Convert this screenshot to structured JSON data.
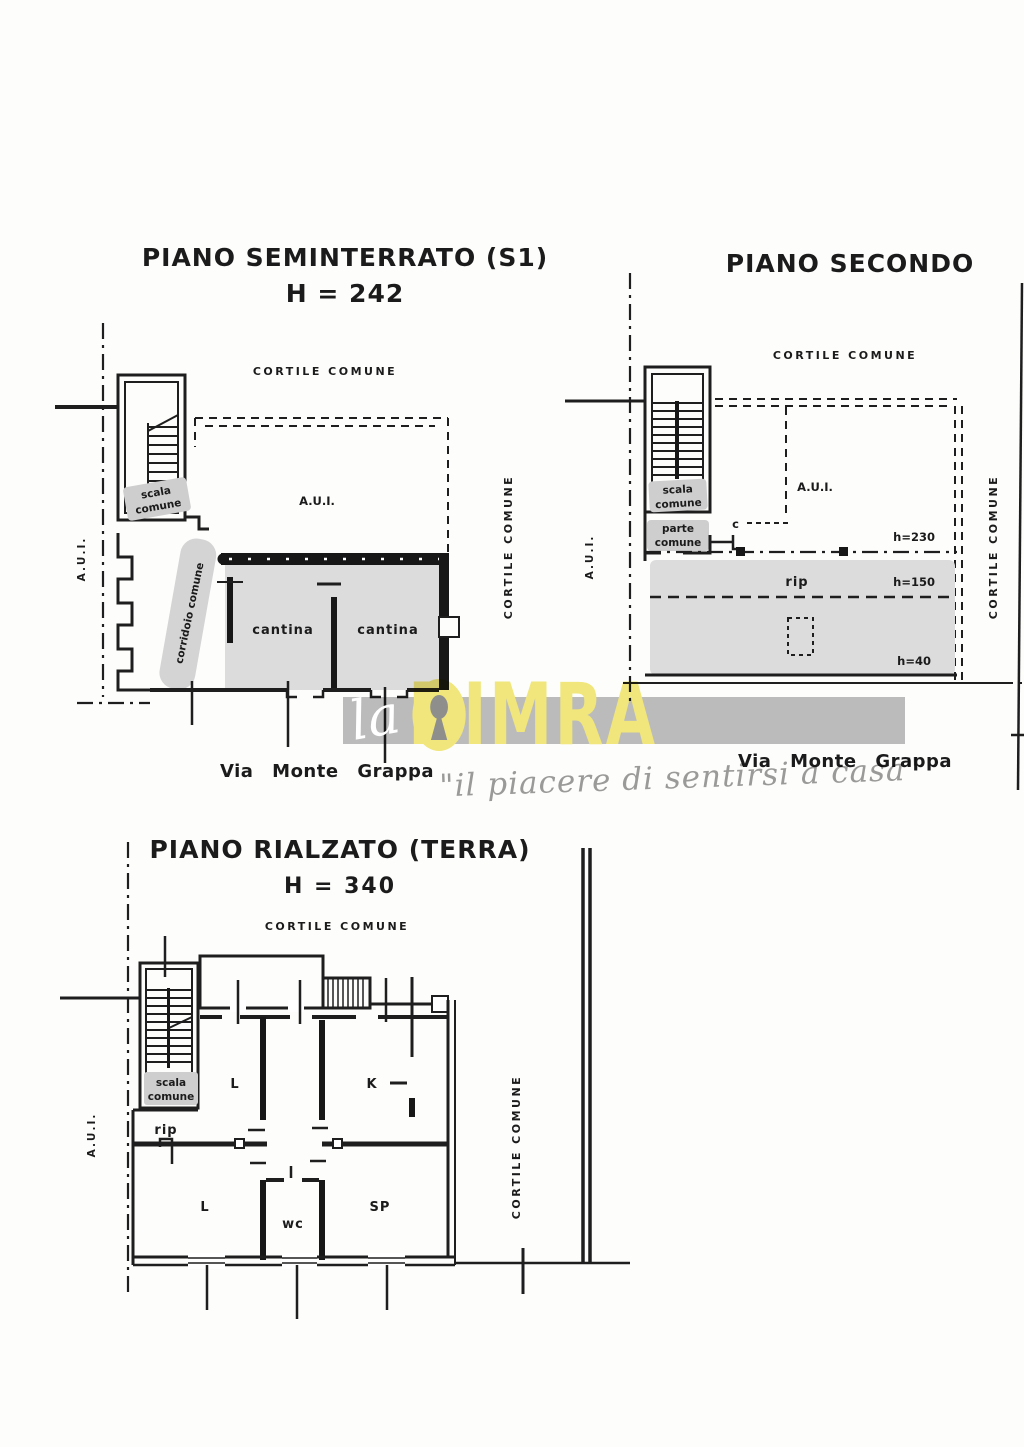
{
  "plans": {
    "s1": {
      "title": "PIANO SEMINTERRATO (S1)",
      "height_label": "H = 242",
      "courtyard_top": "CORTILE COMUNE",
      "courtyard_right": "CORTILE COMUNE",
      "aui_left": "A.U.I.",
      "aui_area": "A.U.I.",
      "stair_line1": "scala",
      "stair_line2": "comune",
      "corridor": "corridoio comune",
      "cantina_1": "cantina",
      "cantina_2": "cantina",
      "street": "Via Monte Grappa"
    },
    "secondo": {
      "title": "PIANO SECONDO",
      "courtyard_top": "CORTILE COMUNE",
      "courtyard_right": "CORTILE COMUNE",
      "aui_left": "A.U.I.",
      "aui_area": "A.U.I.",
      "stair_line1": "scala",
      "stair_line2": "comune",
      "parte_line1": "parte",
      "parte_line2": "comune",
      "closet": "c",
      "h_230": "h=230",
      "h_150": "h=150",
      "h_40": "h=40",
      "storage": "rip",
      "street": "Via Monte Grappa"
    },
    "rialzato": {
      "title": "PIANO RIALZATO (TERRA)",
      "height_label": "H = 340",
      "courtyard_top": "CORTILE COMUNE",
      "courtyard_right": "CORTILE COMUNE",
      "aui_left": "A.U.I.",
      "stair_line1": "scala",
      "stair_line2": "comune",
      "storage": "rip",
      "room_l_upper": "L",
      "room_k": "K",
      "room_l_lower": "L",
      "room_wc": "wc",
      "room_sp": "SP"
    }
  },
  "watermark": {
    "prefix": "la",
    "brand_left": "DIM",
    "brand_right": "RA",
    "tagline": "\"il piacere di sentirsi a casa\""
  },
  "colors": {
    "ink": "#1b1b1b",
    "room_gray": "#dcdcdc",
    "chip_gray": "#cecece",
    "brand_yellow": "#f2e87c",
    "keyhole_gray": "#8f8f8f",
    "band_gray": "#bdbdbd",
    "tagline_gray": "#9b9b9b"
  }
}
